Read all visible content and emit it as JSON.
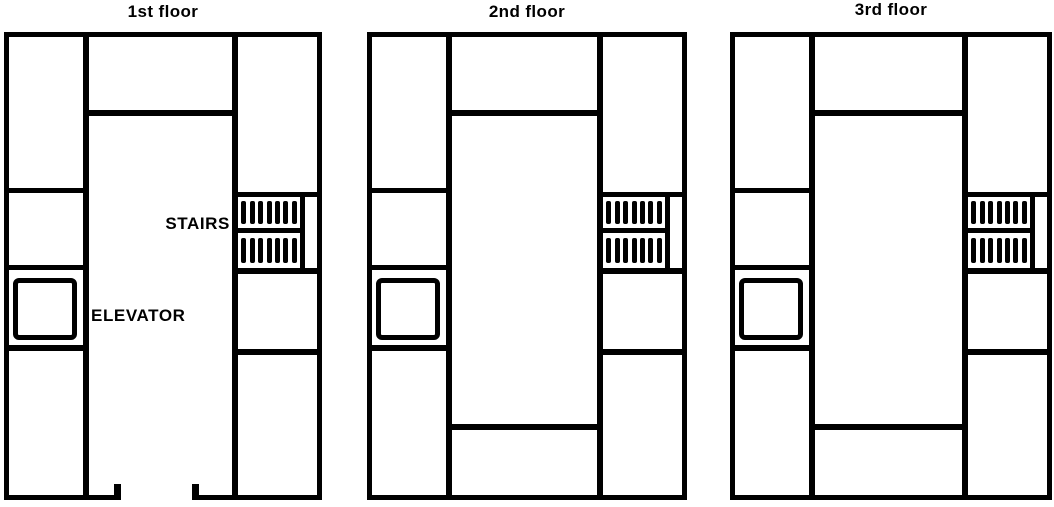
{
  "figure": {
    "description": "Three scanned building floor plans shown side by side",
    "colors": {
      "ink": "#000000",
      "paper": "#ffffff"
    }
  },
  "floors": [
    {
      "id": "floor-1",
      "title": "1st floor",
      "labels": {
        "stairs": "STAIRS",
        "elevator": "ELEVATOR"
      },
      "has_entrance_opening": true,
      "has_enclosed_center_room": false
    },
    {
      "id": "floor-2",
      "title": "2nd floor",
      "has_entrance_opening": false,
      "has_enclosed_center_room": true
    },
    {
      "id": "floor-3",
      "title": "3rd floor",
      "has_entrance_opening": false,
      "has_enclosed_center_room": true
    }
  ],
  "stairs": {
    "flights_per_stairwell": 2,
    "hatch_strokes_per_flight": 7
  }
}
